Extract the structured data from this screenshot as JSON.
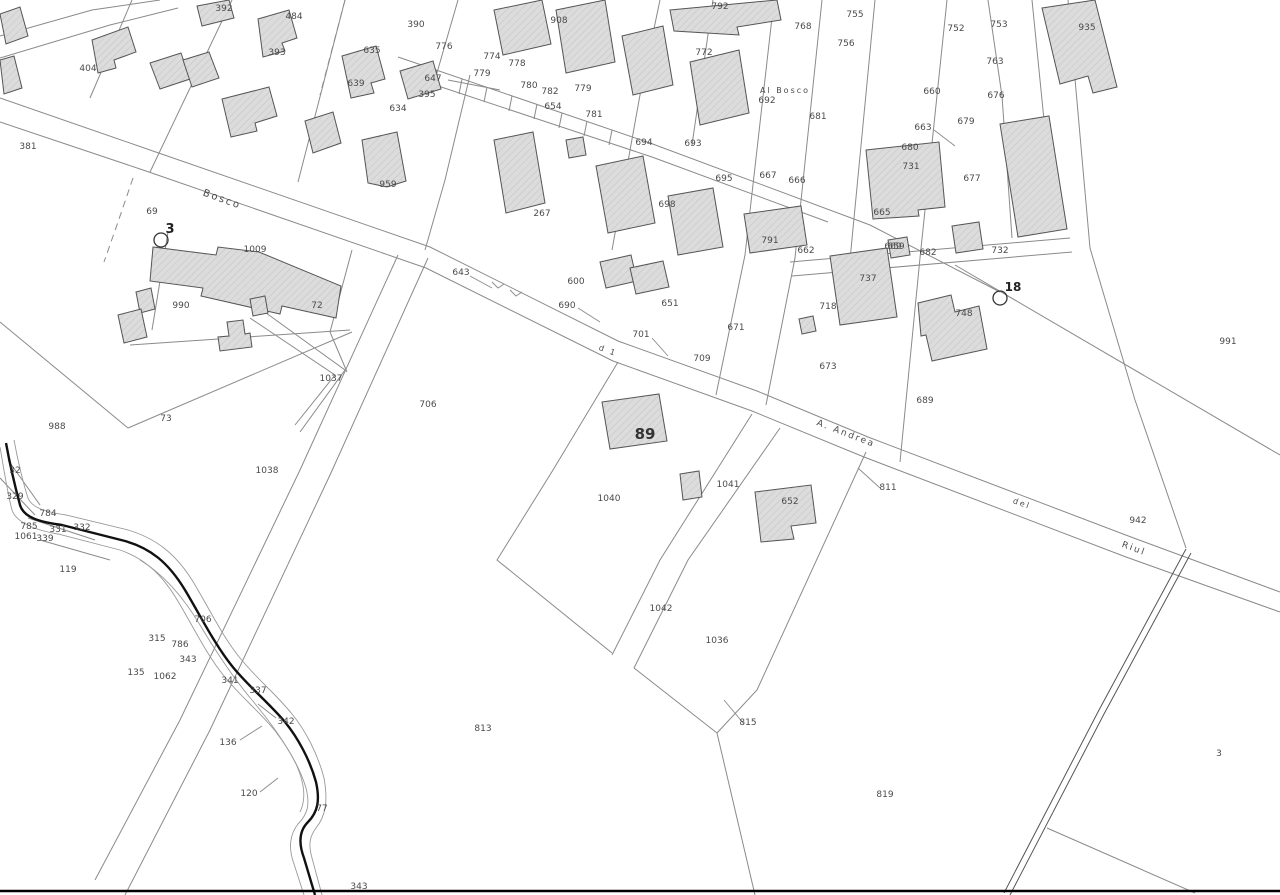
{
  "map": {
    "kind": "cadastral-map-sheet",
    "colors": {
      "background": "#ffffff",
      "boundary_line": "#8a8a8a",
      "building_fill": "#dcdcdc",
      "building_stroke": "#555555",
      "label_text": "#4a4a4a",
      "stream_line": "#111111",
      "frame_line": "#000000"
    },
    "parcel_labels": [
      {
        "t": "392",
        "x": 224,
        "y": 8
      },
      {
        "t": "484",
        "x": 294,
        "y": 16
      },
      {
        "t": "393",
        "x": 277,
        "y": 52
      },
      {
        "t": "404",
        "x": 88,
        "y": 68
      },
      {
        "t": "381",
        "x": 28,
        "y": 146
      },
      {
        "t": "390",
        "x": 416,
        "y": 24
      },
      {
        "t": "908",
        "x": 559,
        "y": 20
      },
      {
        "t": "635",
        "x": 372,
        "y": 50
      },
      {
        "t": "639",
        "x": 356,
        "y": 83
      },
      {
        "t": "647",
        "x": 433,
        "y": 78
      },
      {
        "t": "395",
        "x": 427,
        "y": 94
      },
      {
        "t": "634",
        "x": 398,
        "y": 108
      },
      {
        "t": "776",
        "x": 444,
        "y": 46
      },
      {
        "t": "774",
        "x": 492,
        "y": 56
      },
      {
        "t": "778",
        "x": 517,
        "y": 63
      },
      {
        "t": "779",
        "x": 482,
        "y": 73
      },
      {
        "t": "780",
        "x": 529,
        "y": 85
      },
      {
        "t": "782",
        "x": 550,
        "y": 91
      },
      {
        "t": "779",
        "x": 583,
        "y": 88
      },
      {
        "t": "654",
        "x": 553,
        "y": 106
      },
      {
        "t": "781",
        "x": 594,
        "y": 114
      },
      {
        "t": "694",
        "x": 644,
        "y": 142
      },
      {
        "t": "792",
        "x": 720,
        "y": 6
      },
      {
        "t": "772",
        "x": 704,
        "y": 52
      },
      {
        "t": "755",
        "x": 855,
        "y": 14
      },
      {
        "t": "768",
        "x": 803,
        "y": 26
      },
      {
        "t": "756",
        "x": 846,
        "y": 43
      },
      {
        "t": "752",
        "x": 956,
        "y": 28
      },
      {
        "t": "753",
        "x": 999,
        "y": 24
      },
      {
        "t": "935",
        "x": 1087,
        "y": 27
      },
      {
        "t": "763",
        "x": 995,
        "y": 61
      },
      {
        "t": "676",
        "x": 996,
        "y": 95
      },
      {
        "t": "679",
        "x": 966,
        "y": 121
      },
      {
        "t": "660",
        "x": 932,
        "y": 91
      },
      {
        "t": "692",
        "x": 767,
        "y": 100
      },
      {
        "t": "681",
        "x": 818,
        "y": 116
      },
      {
        "t": "663",
        "x": 923,
        "y": 127
      },
      {
        "t": "680",
        "x": 910,
        "y": 147
      },
      {
        "t": "731",
        "x": 911,
        "y": 166
      },
      {
        "t": "677",
        "x": 972,
        "y": 178
      },
      {
        "t": "693",
        "x": 693,
        "y": 143
      },
      {
        "t": "695",
        "x": 724,
        "y": 178
      },
      {
        "t": "667",
        "x": 768,
        "y": 175
      },
      {
        "t": "666",
        "x": 797,
        "y": 180
      },
      {
        "t": "698",
        "x": 667,
        "y": 204
      },
      {
        "t": "665",
        "x": 882,
        "y": 212
      },
      {
        "t": "669",
        "x": 893,
        "y": 246
      },
      {
        "t": "791",
        "x": 770,
        "y": 240
      },
      {
        "t": "662",
        "x": 806,
        "y": 250
      },
      {
        "t": "659",
        "x": 896,
        "y": 246
      },
      {
        "t": "682",
        "x": 928,
        "y": 252
      },
      {
        "t": "732",
        "x": 1000,
        "y": 250
      },
      {
        "t": "737",
        "x": 868,
        "y": 278
      },
      {
        "t": "718",
        "x": 828,
        "y": 306
      },
      {
        "t": "748",
        "x": 964,
        "y": 313
      },
      {
        "t": "673",
        "x": 828,
        "y": 366
      },
      {
        "t": "689",
        "x": 925,
        "y": 400
      },
      {
        "t": "267",
        "x": 542,
        "y": 213
      },
      {
        "t": "959",
        "x": 388,
        "y": 184
      },
      {
        "t": "69",
        "x": 152,
        "y": 211
      },
      {
        "t": "1009",
        "x": 255,
        "y": 249
      },
      {
        "t": "990",
        "x": 181,
        "y": 305
      },
      {
        "t": "72",
        "x": 317,
        "y": 305
      },
      {
        "t": "1037",
        "x": 331,
        "y": 378
      },
      {
        "t": "988",
        "x": 57,
        "y": 426
      },
      {
        "t": "73",
        "x": 166,
        "y": 418
      },
      {
        "t": "643",
        "x": 461,
        "y": 272
      },
      {
        "t": "600",
        "x": 576,
        "y": 281
      },
      {
        "t": "690",
        "x": 567,
        "y": 305
      },
      {
        "t": "651",
        "x": 670,
        "y": 303
      },
      {
        "t": "701",
        "x": 641,
        "y": 334
      },
      {
        "t": "709",
        "x": 702,
        "y": 358
      },
      {
        "t": "671",
        "x": 736,
        "y": 327
      },
      {
        "t": "706",
        "x": 428,
        "y": 404
      },
      {
        "t": "1040",
        "x": 609,
        "y": 498
      },
      {
        "t": "1041",
        "x": 728,
        "y": 484
      },
      {
        "t": "652",
        "x": 790,
        "y": 501
      },
      {
        "t": "811",
        "x": 888,
        "y": 487
      },
      {
        "t": "991",
        "x": 1228,
        "y": 341
      },
      {
        "t": "942",
        "x": 1138,
        "y": 520
      },
      {
        "t": "32",
        "x": 15,
        "y": 470
      },
      {
        "t": "329",
        "x": 15,
        "y": 496
      },
      {
        "t": "784",
        "x": 48,
        "y": 513
      },
      {
        "t": "785",
        "x": 29,
        "y": 526
      },
      {
        "t": "1061",
        "x": 26,
        "y": 536
      },
      {
        "t": "331",
        "x": 58,
        "y": 529
      },
      {
        "t": "332",
        "x": 82,
        "y": 527
      },
      {
        "t": "339",
        "x": 45,
        "y": 538
      },
      {
        "t": "119",
        "x": 68,
        "y": 569
      },
      {
        "t": "1038",
        "x": 267,
        "y": 470
      },
      {
        "t": "706",
        "x": 203,
        "y": 619
      },
      {
        "t": "315",
        "x": 157,
        "y": 638
      },
      {
        "t": "786",
        "x": 180,
        "y": 644
      },
      {
        "t": "343",
        "x": 188,
        "y": 659
      },
      {
        "t": "135",
        "x": 136,
        "y": 672
      },
      {
        "t": "1062",
        "x": 165,
        "y": 676
      },
      {
        "t": "341",
        "x": 230,
        "y": 680
      },
      {
        "t": "337",
        "x": 258,
        "y": 690
      },
      {
        "t": "342",
        "x": 286,
        "y": 721
      },
      {
        "t": "136",
        "x": 228,
        "y": 742
      },
      {
        "t": "120",
        "x": 249,
        "y": 793
      },
      {
        "t": "77",
        "x": 322,
        "y": 808
      },
      {
        "t": "343",
        "x": 359,
        "y": 886
      },
      {
        "t": "1042",
        "x": 661,
        "y": 608
      },
      {
        "t": "1036",
        "x": 717,
        "y": 640
      },
      {
        "t": "813",
        "x": 483,
        "y": 728
      },
      {
        "t": "815",
        "x": 748,
        "y": 722
      },
      {
        "t": "819",
        "x": 885,
        "y": 794
      },
      {
        "t": "3",
        "x": 1219,
        "y": 753
      },
      {
        "t": "89",
        "x": 645,
        "y": 436,
        "s": 15,
        "b": true
      }
    ],
    "road_names": [
      {
        "t": "Bosco",
        "x": 221,
        "y": 199,
        "r": 20,
        "s": 10
      },
      {
        "t": "Al Bosco",
        "x": 785,
        "y": 90,
        "r": 0,
        "s": 8
      },
      {
        "t": "A. Andrea",
        "x": 845,
        "y": 433,
        "r": 21,
        "s": 9
      },
      {
        "t": "d 1",
        "x": 607,
        "y": 350,
        "r": 20,
        "s": 8
      },
      {
        "t": "del",
        "x": 1021,
        "y": 503,
        "r": 20,
        "s": 8
      },
      {
        "t": "Riul",
        "x": 1133,
        "y": 548,
        "r": 20,
        "s": 9
      }
    ],
    "survey_markers": [
      {
        "label": "3",
        "cx": 161,
        "cy": 240,
        "lx": 170,
        "ly": 233,
        "s": 13
      },
      {
        "label": "18",
        "cx": 1000,
        "cy": 298,
        "lx": 1013,
        "ly": 291,
        "s": 12
      }
    ]
  }
}
